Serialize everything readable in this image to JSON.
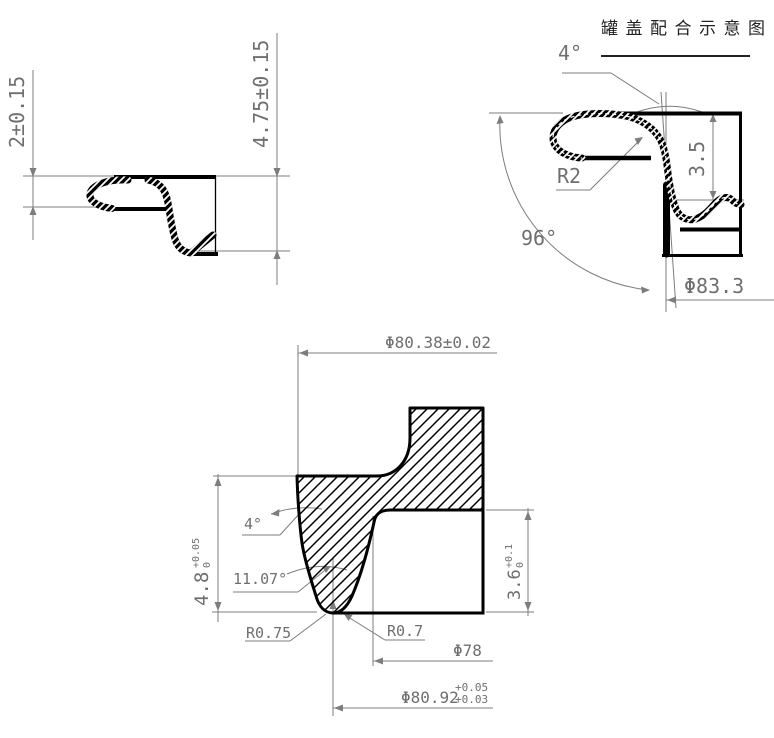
{
  "title": "罐盖配合示意图",
  "colors": {
    "line": "#7d7d7d",
    "text": "#6f6f6f",
    "profile": "#000000",
    "title": "#222222"
  },
  "view_top_left": {
    "description": "can-end curl cross-section",
    "dim_curl_height": "2±0.15",
    "dim_total_height": "4.75±0.15"
  },
  "view_top_right": {
    "description": "lid-to-can seam fit detail",
    "angle_wall": "4°",
    "radius_curl": "R2",
    "dim_seam_height": "3.5",
    "angle_seam": "96°",
    "dim_diameter": "Φ83.3"
  },
  "view_bottom": {
    "description": "tooling groove cross-section",
    "dim_diameter_top": "Φ80.38±0.02",
    "angle_wall": "4°",
    "dim_height": "4.8",
    "dim_height_tol_up": "+0.05",
    "dim_height_tol_low": "0",
    "angle_groove": "11.07°",
    "radius_tip": "R0.75",
    "radius_fillet": "R0.7",
    "dim_step_height": "3.6",
    "dim_step_tol_up": "+0.1",
    "dim_step_tol_low": "0",
    "dim_diameter_inner": "Φ78",
    "dim_diameter_tip": "Φ80.92",
    "dim_diameter_tip_tol_up": "+0.05",
    "dim_diameter_tip_tol_low": "+0.03"
  }
}
